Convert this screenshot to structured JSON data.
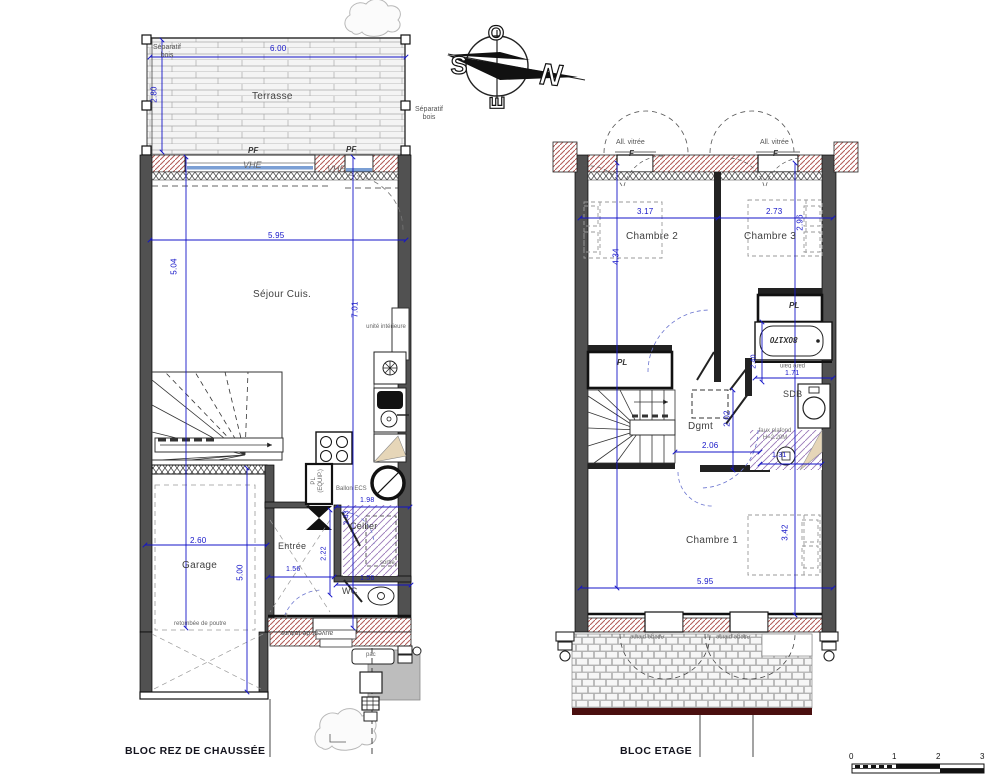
{
  "gf": {
    "title": "BLOC REZ DE CHAUSSÉE",
    "rooms": {
      "terrasse": "Terrasse",
      "sejour": "Séjour Cuis.",
      "garage": "Garage",
      "entree": "Entrée",
      "cellier": "Cellier",
      "wc": "WC"
    },
    "labels": {
      "sep_l": "Séparatif bois",
      "sep_r": "Séparatif bois",
      "pf1": "PF",
      "pf2": "PF",
      "vhe1": "VHE",
      "vhe2": "VHE",
      "unite": "unité intérieure",
      "pl_equip": "PL (EQUIP.)",
      "ballon": "Ballon ECS",
      "retombee": "retombée de poutre",
      "sortie": "sortie",
      "f_door": "F",
      "auvent": "auvent de toiture",
      "pac": "pac"
    },
    "dims": {
      "d600": "6.00",
      "d280": "2.80",
      "d595": "5.95",
      "d504": "5.04",
      "d701": "7.01",
      "d260": "2.60",
      "d500": "5.00",
      "d198": "1.98",
      "d243": "2.43",
      "d156a": "1.56",
      "d222": "2.22",
      "d156b": "1.56"
    }
  },
  "uf": {
    "title": "BLOC ETAGE",
    "rooms": {
      "ch1": "Chambre 1",
      "ch2": "Chambre 2",
      "ch3": "Chambre 3",
      "sdb": "SDB",
      "dgmt": "Dgmt"
    },
    "labels": {
      "av1": "All. vitrée",
      "av2": "All. vitrée",
      "f1": "F",
      "f2": "F",
      "pl1": "PL",
      "pl2": "PL",
      "tub": "80X170",
      "pare_bain": "pare bain",
      "faux_plafond": "faux plafond H=2.20M",
      "allege1": "Allège pleine",
      "allege2": "Allège pleine"
    },
    "dims": {
      "d317": "3.17",
      "d273": "2.73",
      "d434": "4.34",
      "d296": "2.96",
      "d240": "2.40",
      "d171": "1.71",
      "d202": "2.02",
      "d206": "2.06",
      "d342": "3.42",
      "d595": "5.95",
      "d131": "1.31"
    }
  },
  "compass": {
    "o": "O",
    "s": "S",
    "e": "E",
    "n": "N"
  },
  "scale_bar": {
    "n0": "0",
    "n1": "1",
    "n2": "2",
    "n3": "3"
  }
}
